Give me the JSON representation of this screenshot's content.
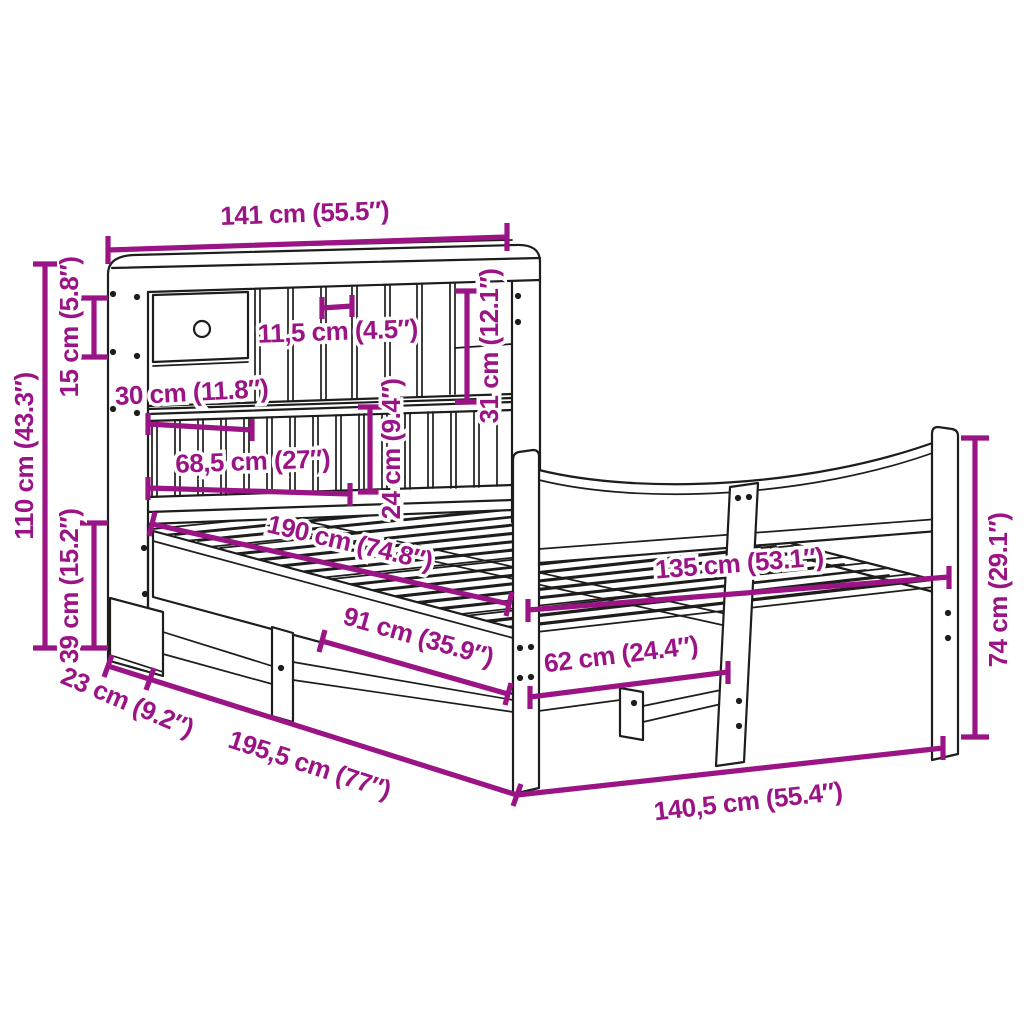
{
  "diagram": {
    "kind": "furniture dimension diagram",
    "subject": "bed frame with bookcase headboard",
    "colors": {
      "dimension_accent": "#9B1486",
      "outline": "#1d1d1b",
      "background": "#ffffff"
    },
    "labels": {
      "d141": "141 cm (55.5″)",
      "d15": "15 cm (5.8″)",
      "d110": "110 cm (43.3″)",
      "d39": "39 cm (15.2″)",
      "d30": "30 cm (11.8″)",
      "d68_5": "68,5 cm (27″)",
      "d11_5": "11,5 cm (4.5″)",
      "d31": "31 cm (12.1″)",
      "d24": "24 cm (9.4″)",
      "d190": "190 cm (74.8″)",
      "d135": "135 cm (53.1″)",
      "d62": "62 cm (24.4″)",
      "d91": "91 cm (35.9″)",
      "d74": "74 cm (29.1″)",
      "d23": "23 cm (9.2″)",
      "d195_5": "195,5 cm (77″)",
      "d140_5": "140,5 cm (55.4″)"
    }
  }
}
